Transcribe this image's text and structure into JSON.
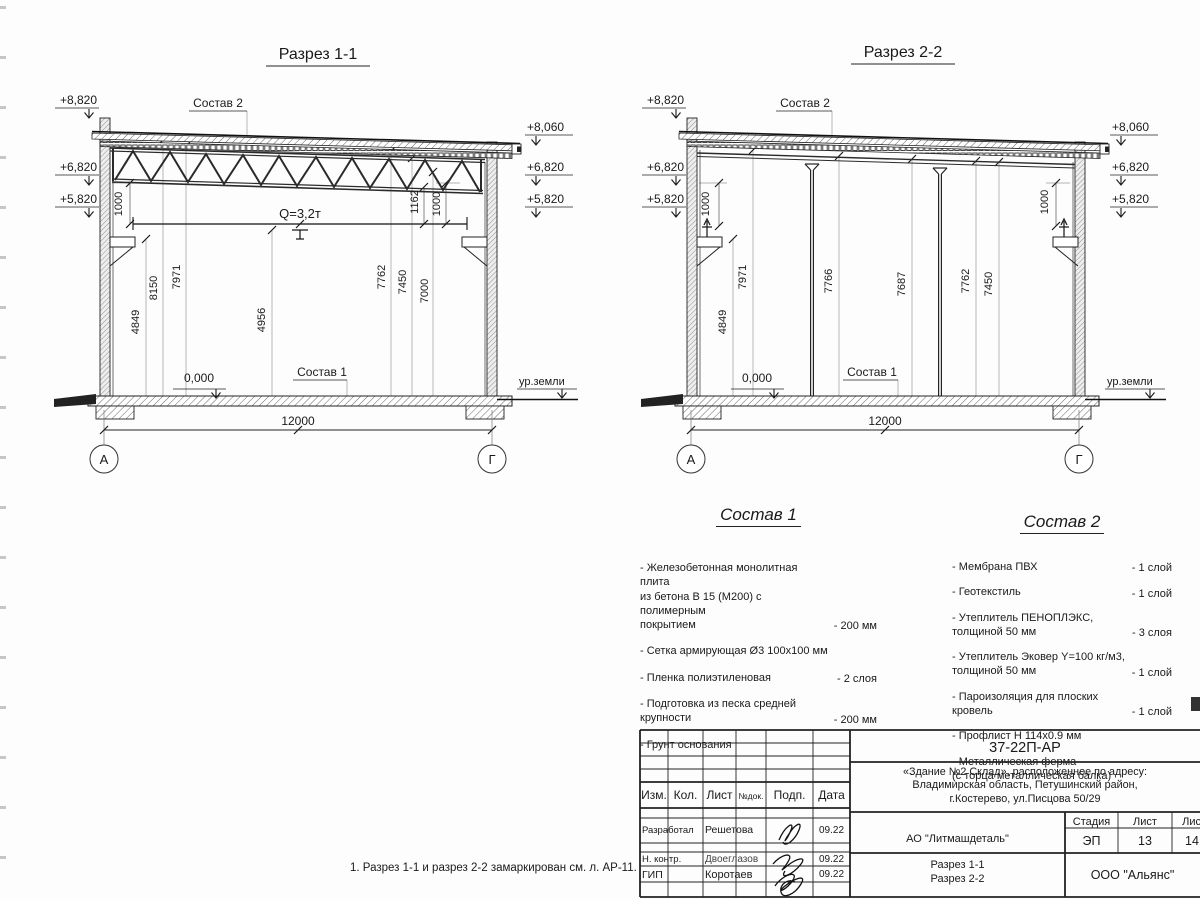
{
  "s1": {
    "title": "Разрез 1-1",
    "roof_label": "Состав 2",
    "floor_label": "Состав 1",
    "crane_label": "Q=3,2т",
    "zero_mark": "0,000",
    "ground_label": "ур.земли",
    "span_dim": "12000",
    "axis_left": "А",
    "axis_right": "Г",
    "elev_left": [
      "+8,820",
      "+6,820",
      "+5,820"
    ],
    "elev_right": [
      "+8,060",
      "+6,820",
      "+5,820"
    ],
    "dims": [
      "1000",
      "4849",
      "8150",
      "7971",
      "4956",
      "7762",
      "7450",
      "7000",
      "1162",
      "1000"
    ]
  },
  "s2": {
    "title": "Разрез 2-2",
    "roof_label": "Состав 2",
    "floor_label": "Состав 1",
    "zero_mark": "0,000",
    "ground_label": "ур.земли",
    "span_dim": "12000",
    "axis_left": "А",
    "axis_right": "Г",
    "elev_left": [
      "+8,820",
      "+6,820",
      "+5,820"
    ],
    "elev_right": [
      "+8,060",
      "+6,820",
      "+5,820"
    ],
    "dims": [
      "1000",
      "4849",
      "7971",
      "7766",
      "7687",
      "7762",
      "7450",
      "1000"
    ]
  },
  "sostav1": {
    "title": "Состав 1",
    "items": [
      {
        "name": "- Железобетонная  монолитная плита\nиз бетона В 15 (М200) с полимерным\nпокрытием",
        "value": "- 200 мм"
      },
      {
        "name": "- Сетка армирующая Ø3 100х100 мм",
        "value": ""
      },
      {
        "name": "- Пленка полиэтиленовая",
        "value": "-  2 слоя"
      },
      {
        "name": "- Подготовка из песка средней\n   крупности",
        "value": "- 200 мм"
      },
      {
        "name": "- Грунт основания",
        "value": ""
      }
    ]
  },
  "sostav2": {
    "title": "Состав 2",
    "items": [
      {
        "name": "- Мембрана ПВХ",
        "value": "- 1 слой"
      },
      {
        "name": "- Геотекстиль",
        "value": "- 1 слой"
      },
      {
        "name": "- Утеплитель ПЕНОПЛЭКС,\n   толщиной 50 мм",
        "value": "- 3 слоя"
      },
      {
        "name": "- Утеплитель Эковер Y=100 кг/м3,\n   толщиной 50 мм",
        "value": "- 1 слой"
      },
      {
        "name": "- Пароизоляция для плоских кровель",
        "value": "- 1 слой"
      },
      {
        "name": "- Профлист Н 114х0.9 мм",
        "value": ""
      },
      {
        "name": "- Металлическая ферма\n   (с торца металлическая балка)",
        "value": ""
      }
    ]
  },
  "note": "1. Разрез 1-1 и разрез 2-2 замаркирован см. л. АР-11.",
  "titleblock": {
    "doc_code": "37-22П-АР",
    "object_desc": "«Здание №2 Склад», расположенное по адресу:\nВладимирская область, Петушинский район,\nг.Костерево, ул.Писцова 50/29",
    "client": "АО \"Литмашдеталь\"",
    "sheet_name": "Разрез 1-1\nРазрез 2-2",
    "company": "ООО \"Альянс\"",
    "cols": [
      "Изм.",
      "Кол.",
      "Лист",
      "№док.",
      "Подп.",
      "Дата"
    ],
    "stage_label": "Стадия",
    "sheet_label": "Лист",
    "sheets_label": "Листов",
    "stage": "ЭП",
    "sheet_no": "13",
    "sheets_total": "14",
    "rows": [
      {
        "role": "Разработал",
        "name": "Решетова",
        "date": "09.22"
      },
      {
        "role": "Н. контр.",
        "name": "Двоеглазов",
        "date": "09.22"
      },
      {
        "role": "ГИП",
        "name": "Коротаев",
        "date": "09.22"
      }
    ]
  }
}
